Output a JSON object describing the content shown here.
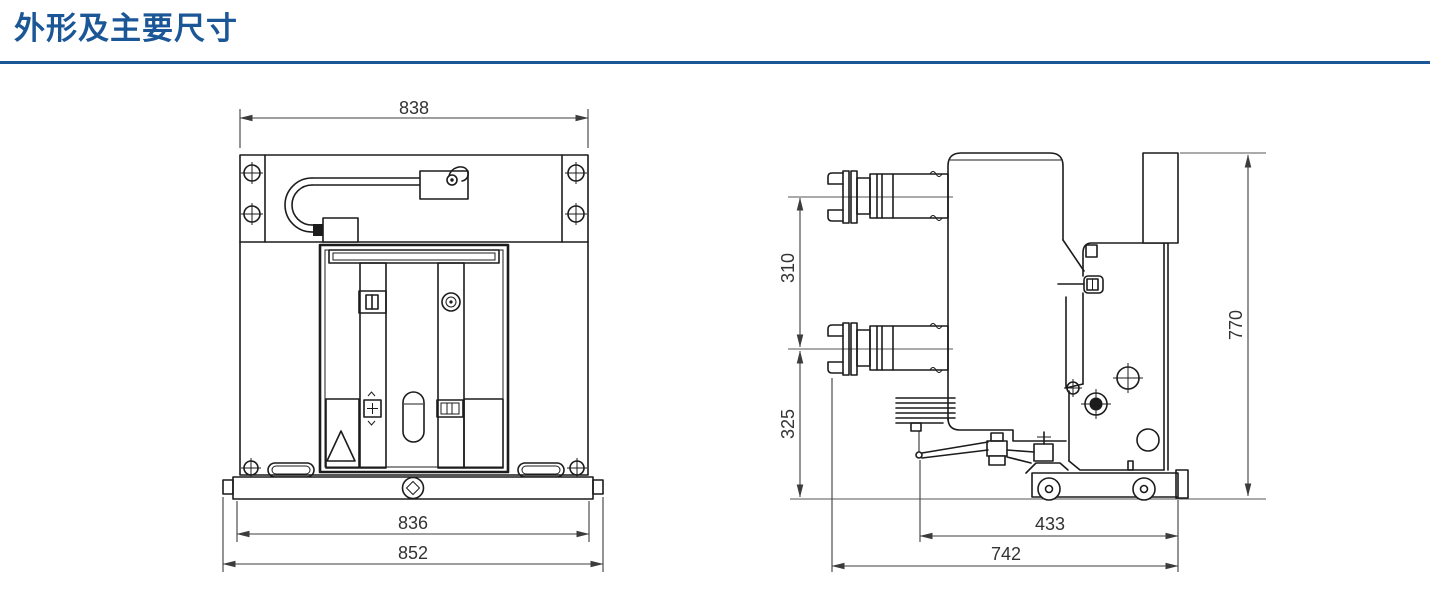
{
  "page": {
    "title": "外形及主要尺寸",
    "accent_color": "#1b5696",
    "line_color": "#1c1c1c",
    "dim_text_color": "#333333",
    "background": "#ffffff"
  },
  "front_view": {
    "dims": {
      "top_width": "838",
      "base_width": "836",
      "overall_width": "852"
    }
  },
  "side_view": {
    "dims": {
      "pole_center_spacing": "310",
      "lower_section_height": "325",
      "overall_height": "770",
      "base_length": "433",
      "overall_depth": "742"
    }
  }
}
